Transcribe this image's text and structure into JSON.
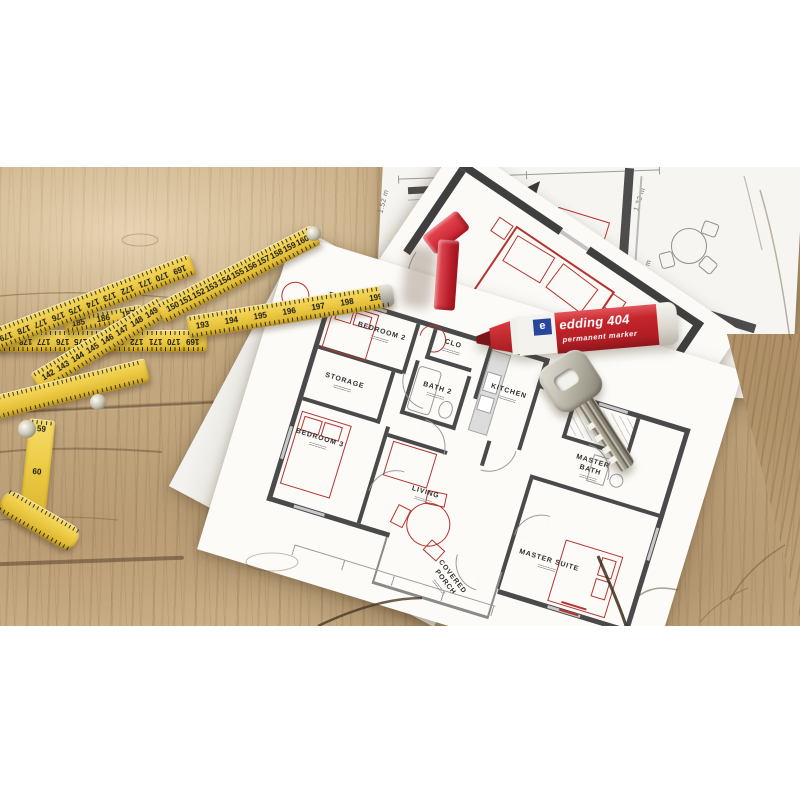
{
  "floor_plan": {
    "rooms": {
      "bedroom2": "BEDROOM 2",
      "storage": "STORAGE",
      "clo": "CLO",
      "bath2": "BATH 2",
      "kitchen": "KITCHEN",
      "bedroom3": "BEDROOM 3",
      "living": "LIVING",
      "wic": "W.I.C.",
      "master_bath": "MASTER BATH",
      "master_suite": "MASTER SUITE",
      "covered_porch": "COVERED PORCH"
    }
  },
  "detail_sheet": {
    "room": "BEDROOM 3",
    "dim_top_1": "3.00 m",
    "dim_top_2": "1.52 m",
    "dim_left": "1.52 m",
    "dim_right_upper": "1.32 m",
    "dim_right_lower": "3.53 m"
  },
  "marker": {
    "brand": "edding 404",
    "type": "permanent marker",
    "logo_letter": "e"
  },
  "ruler": {
    "segment_upper": [
      "150",
      "151",
      "152",
      "153",
      "154",
      "155",
      "156",
      "157",
      "158",
      "159",
      "160"
    ],
    "segment_lower": [
      "142",
      "143",
      "144",
      "145",
      "146",
      "147",
      "148",
      "149"
    ],
    "segment_front": [
      "193",
      "194",
      "195",
      "196",
      "197",
      "198",
      "199"
    ],
    "segment_back_inverted": [
      "179",
      "178",
      "177",
      "176",
      "175",
      "174",
      "173",
      "172",
      "171",
      "170",
      "169"
    ],
    "segment_mid_fragment": [
      "185",
      "186",
      "187"
    ],
    "segment_joint": [
      "59",
      "60",
      "61"
    ]
  },
  "colors": {
    "plan_red": "#b5342f",
    "wall_gray": "#4a4a4a",
    "ruler_yellow": "#edcb45",
    "marker_red": "#c4252b",
    "marker_blue": "#27479e",
    "token_red": "#cf2430",
    "wood": "#c3a87f"
  }
}
